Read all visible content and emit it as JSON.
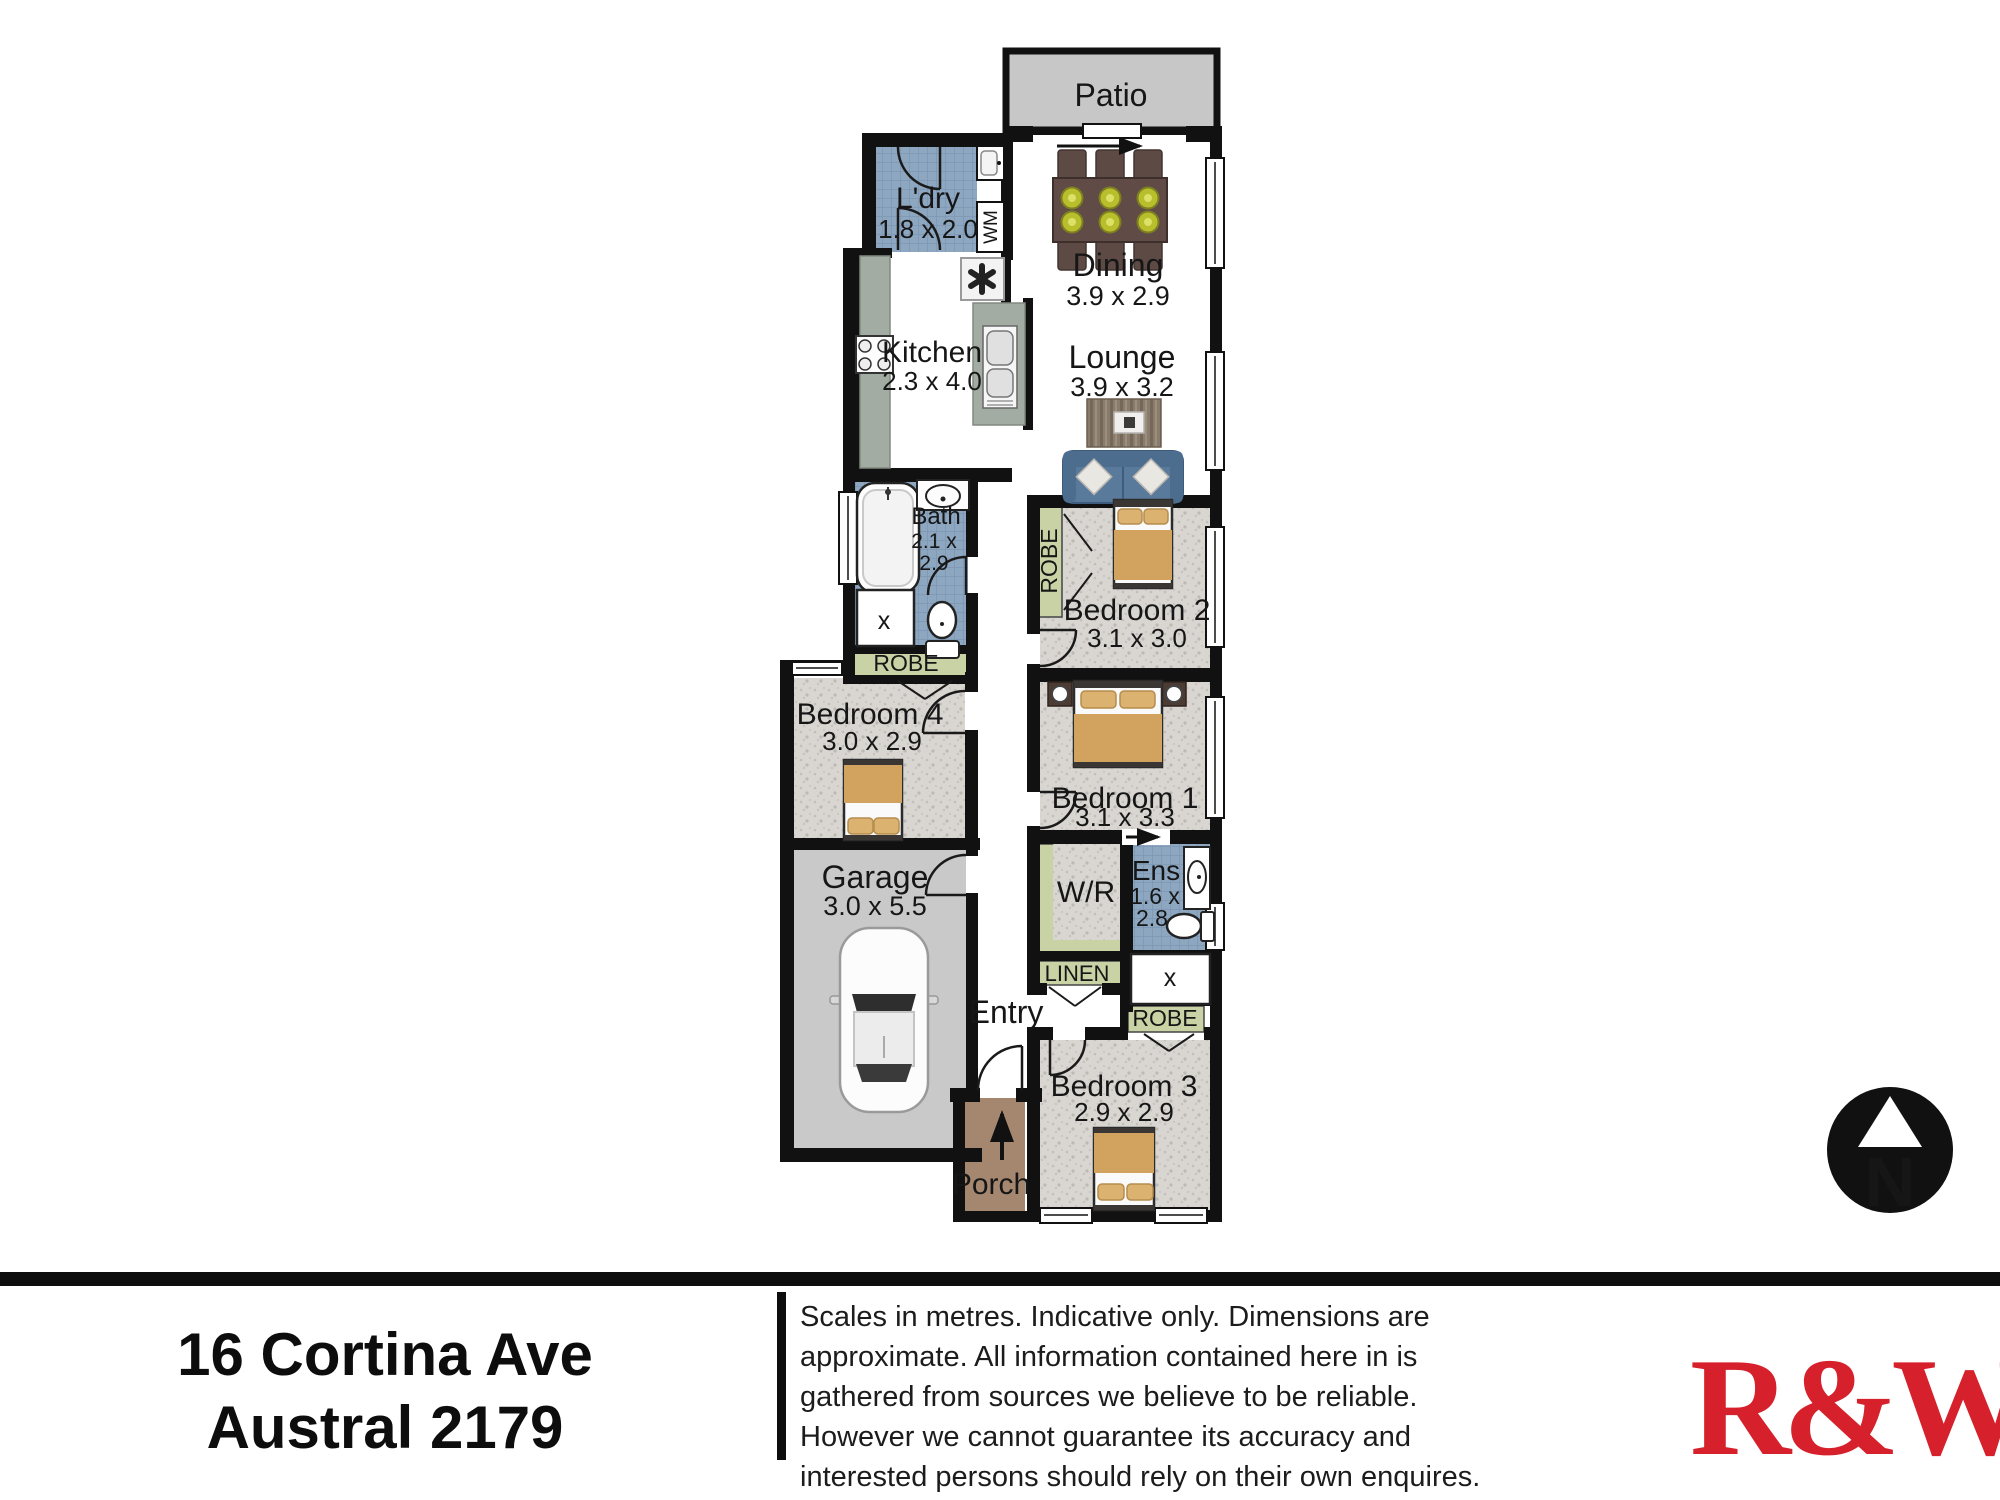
{
  "plan": {
    "patio": {
      "label": "Patio"
    },
    "ldry": {
      "name": "L'dry",
      "dims": "1.8 x 2.0"
    },
    "dining": {
      "name": "Dining",
      "dims": "3.9 x 2.9"
    },
    "kitchen": {
      "name": "Kitchen",
      "dims": "2.3 x 4.0"
    },
    "lounge": {
      "name": "Lounge",
      "dims": "3.9 x 3.2"
    },
    "bath": {
      "name": "Bath",
      "dims1": "2.1 x",
      "dims2": "2.9"
    },
    "bedroom2": {
      "name": "Bedroom 2",
      "dims": "3.1 x 3.0"
    },
    "bedroom4": {
      "name": "Bedroom 4",
      "dims": "3.0 x 2.9"
    },
    "bedroom1": {
      "name": "Bedroom 1",
      "dims": "3.1 x 3.3"
    },
    "garage": {
      "name": "Garage",
      "dims": "3.0 x 5.5"
    },
    "wr": {
      "name": "W/R"
    },
    "ens": {
      "name": "Ens",
      "dims1": "1.6 x",
      "dims2": "2.8"
    },
    "bedroom3": {
      "name": "Bedroom 3",
      "dims": "2.9 x 2.9"
    },
    "entry": {
      "name": "Entry"
    },
    "porch": {
      "name": "Porch"
    },
    "labels": {
      "robe": "ROBE",
      "linen": "LINEN",
      "wm": "WM",
      "shower": "x",
      "north": "N"
    }
  },
  "footer": {
    "address_line1": "16 Cortina Ave",
    "address_line2": "Austral 2179",
    "disclaimer_lines": [
      "Scales in metres. Indicative only. Dimensions are",
      "approximate. All information contained here in is",
      "gathered from sources we believe to be reliable.",
      "However we cannot guarantee its accuracy and",
      "interested persons should rely on their own enquires."
    ],
    "logo": "R&W"
  },
  "colors": {
    "logo_red": "#d6202b",
    "tile_blue": "#8ea7c1",
    "robe_green": "#c8d2a4",
    "carpet_gray": "#d9d6d2",
    "patio_gray": "#c7c7c7",
    "porch_brown": "#a5876f",
    "wall_black": "#111111"
  }
}
